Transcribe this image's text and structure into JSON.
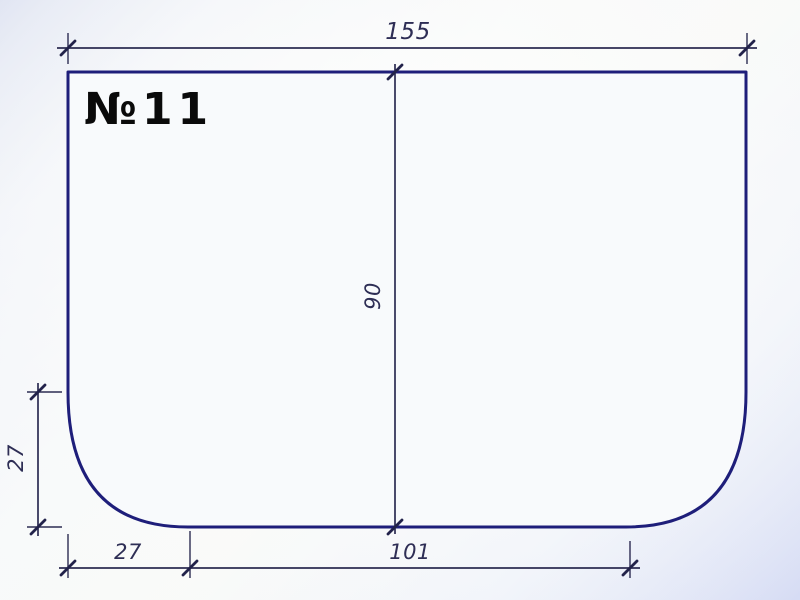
{
  "drawing": {
    "part_label": "№11",
    "dims": {
      "width_top": "155",
      "height_mid": "90",
      "corner_height_left": "27",
      "bottom_corner_width": "27",
      "bottom_flat_width": "101"
    },
    "colors": {
      "outline": "#1e1e7a",
      "dimension_line": "#2c2c52",
      "dimension_text": "#2e2e55",
      "label_text": "#0a0a0a",
      "background_corner": "#c7cfeb",
      "background_center": "#fafbfa"
    }
  }
}
